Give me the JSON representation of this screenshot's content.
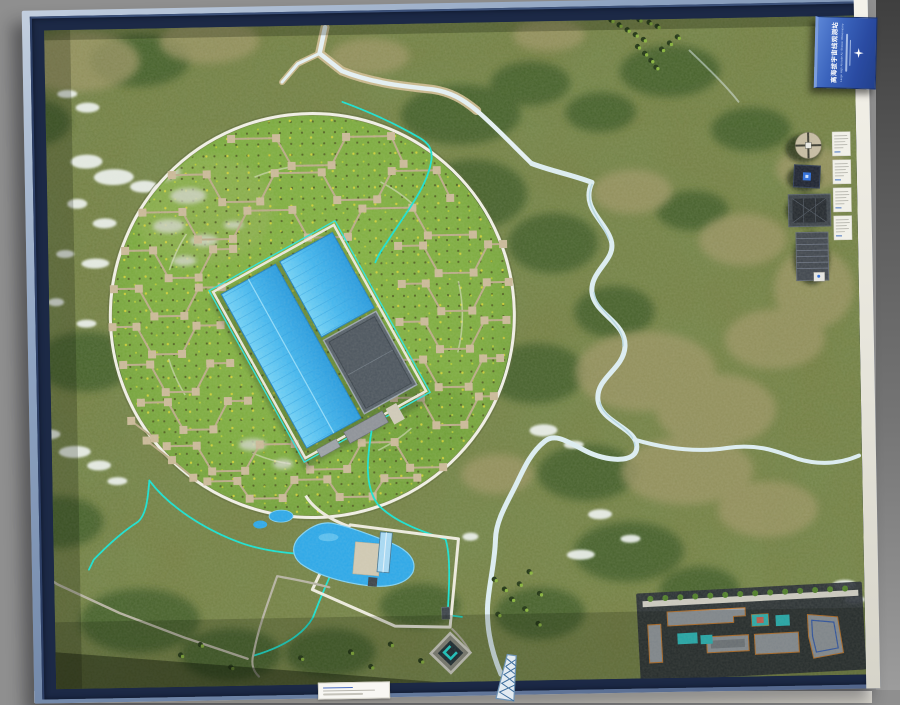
{
  "sign_plaque": {
    "title_cn": "高海拔宇宙线观测站",
    "title_en": "Large High Altitude Air Shower Observatory",
    "icon": "compass-rose-icon"
  },
  "exhibit_cards": {
    "count": 4
  },
  "base_label_card": {
    "count": 1
  },
  "palette": {
    "table_gray": "#8f8f8f",
    "frame_steel": "#8ea3c1",
    "frame_navy": "#1c2946",
    "terrain_base": "#747e42",
    "array_grass": "#7cab3e",
    "array_path_tan": "#b9aa87",
    "ring_white": "#f0efe6",
    "roof_blue": "#41b5ee",
    "roof_dark": "#566069",
    "utility_cyan": "#17e0d0",
    "river_white": "#e6f2f6",
    "lake_blue": "#2ba7e8",
    "campus_edge_orange": "#c87a2e",
    "pool_teal": "#2cc6c9",
    "sign_blue": "#2f5cb0"
  }
}
